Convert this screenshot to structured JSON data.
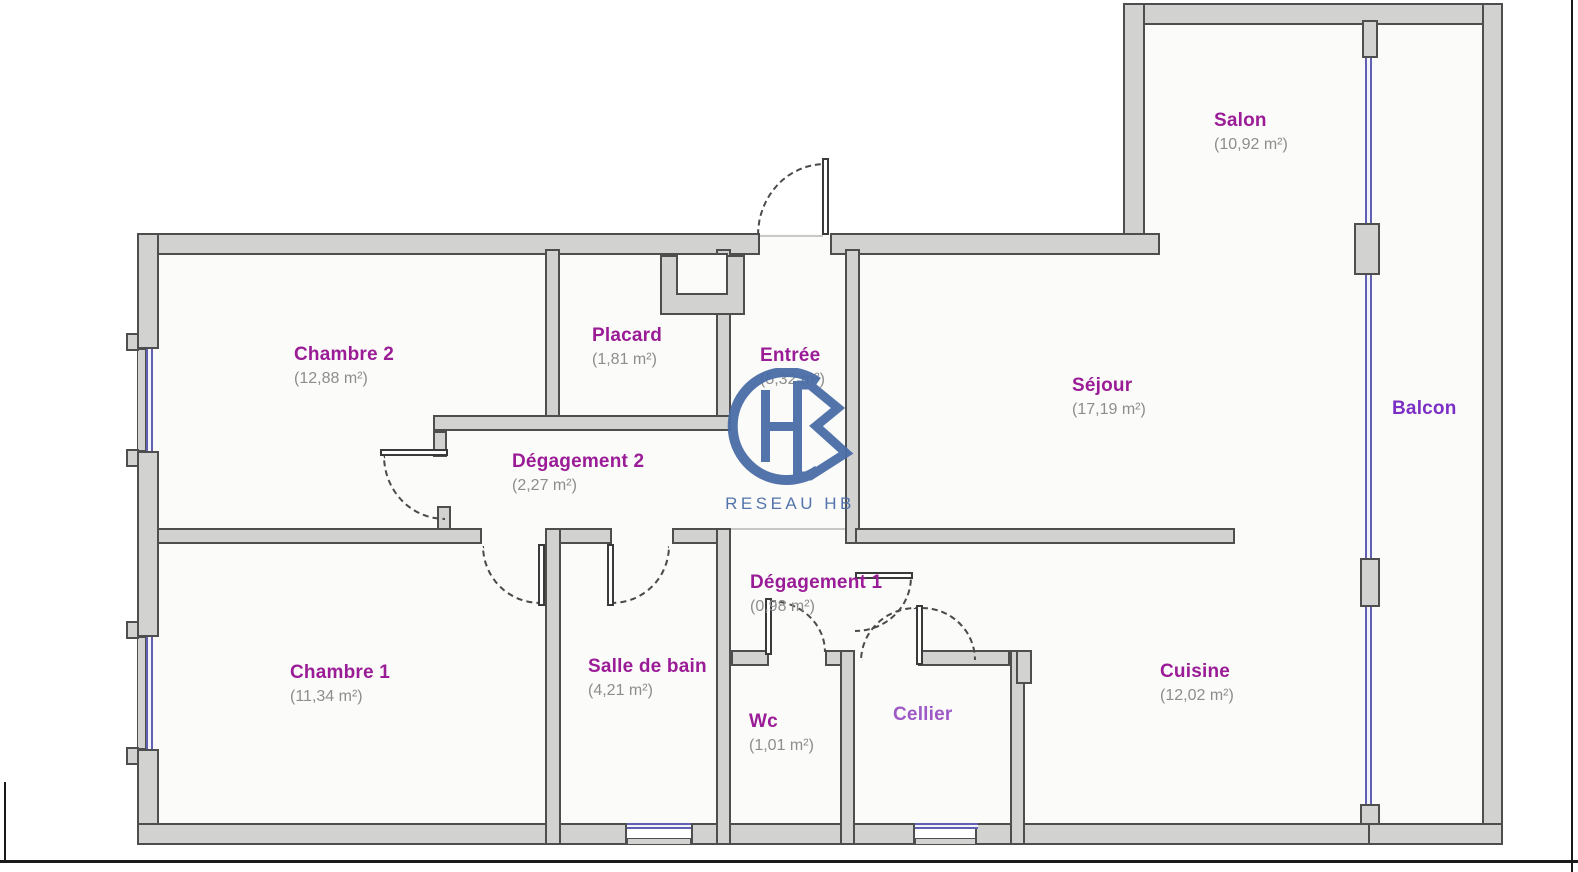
{
  "palette": {
    "room_label": "#9a1c96",
    "balcon_label": "#7b2fc4",
    "cellier_label": "#9d59c6",
    "area_text": "#8d8d8d",
    "wall_fill": "#d2d2d0",
    "wall_edge": "#4e4e4e",
    "window_line": "#6161b3",
    "logo_blue": "#4a6da7",
    "frame_line": "#1a1a1a"
  },
  "watermark": {
    "monogram": "HB",
    "caption": "RESEAU HB"
  },
  "rooms": [
    {
      "id": "salon",
      "name": "Salon",
      "area": "(10,92 m²)"
    },
    {
      "id": "sejour",
      "name": "Séjour",
      "area": "(17,19 m²)"
    },
    {
      "id": "balcon",
      "name": "Balcon",
      "area": ""
    },
    {
      "id": "chambre2",
      "name": "Chambre 2",
      "area": "(12,88 m²)"
    },
    {
      "id": "placard",
      "name": "Placard",
      "area": "(1,81 m²)"
    },
    {
      "id": "entree",
      "name": "Entrée",
      "area": "(5,32 m²)"
    },
    {
      "id": "degagement2",
      "name": "Dégagement 2",
      "area": "(2,27 m²)"
    },
    {
      "id": "chambre1",
      "name": "Chambre 1",
      "area": "(11,34 m²)"
    },
    {
      "id": "salle_de_bain",
      "name": "Salle de bain",
      "area": "(4,21 m²)"
    },
    {
      "id": "degagement1",
      "name": "Dégagement 1",
      "area": "(0,98 m²)"
    },
    {
      "id": "wc",
      "name": "Wc",
      "area": "(1,01 m²)"
    },
    {
      "id": "cellier",
      "name": "Cellier",
      "area": ""
    },
    {
      "id": "cuisine",
      "name": "Cuisine",
      "area": "(12,02 m²)"
    }
  ]
}
